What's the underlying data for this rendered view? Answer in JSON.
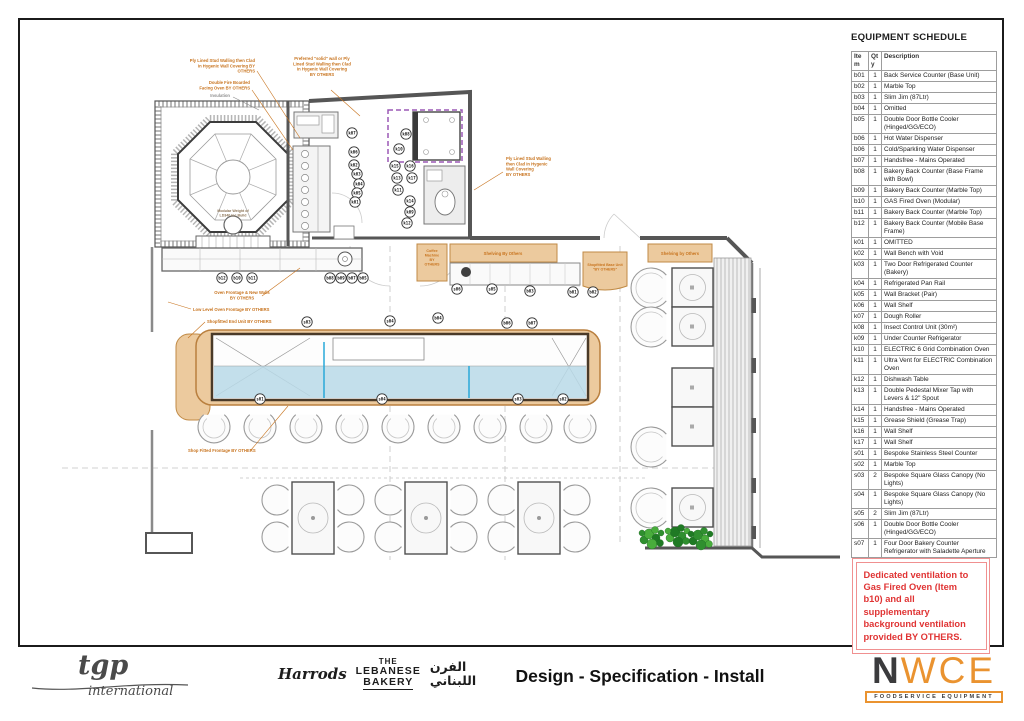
{
  "equipment_schedule": {
    "title": "EQUIPMENT SCHEDULE",
    "columns": [
      "Item",
      "Qty",
      "Description"
    ],
    "rows": [
      [
        "b01",
        "1",
        "Back Service Counter (Base Unit)"
      ],
      [
        "b02",
        "1",
        "Marble Top"
      ],
      [
        "b03",
        "1",
        "Slim Jim (87Ltr)"
      ],
      [
        "b04",
        "1",
        "Omitted"
      ],
      [
        "b05",
        "1",
        "Double Door Bottle Cooler (Hinged/GG/ECO)"
      ],
      [
        "b06",
        "1",
        "Hot Water Dispenser"
      ],
      [
        "b06",
        "1",
        "Cold/Sparkling Water Dispenser"
      ],
      [
        "b07",
        "1",
        "Handsfree - Mains Operated"
      ],
      [
        "b08",
        "1",
        "Bakery Back Counter (Base Frame with Bowl)"
      ],
      [
        "b09",
        "1",
        "Bakery Back Counter (Marble Top)"
      ],
      [
        "b10",
        "1",
        "GAS Fired Oven (Modular)"
      ],
      [
        "b11",
        "1",
        "Bakery Back Counter (Marble Top)"
      ],
      [
        "b12",
        "1",
        "Bakery Back Counter (Mobile Base Frame)"
      ],
      [
        "k01",
        "1",
        "OMITTED"
      ],
      [
        "k02",
        "1",
        "Wall Bench with Void"
      ],
      [
        "k03",
        "1",
        "Two Door Refrigerated Counter (Bakery)"
      ],
      [
        "k04",
        "1",
        "Refrigerated Pan Rail"
      ],
      [
        "k05",
        "1",
        "Wall Bracket (Pair)"
      ],
      [
        "k06",
        "1",
        "Wall Shelf"
      ],
      [
        "k07",
        "1",
        "Dough Roller"
      ],
      [
        "k08",
        "1",
        "Insect Control Unit (30m²)"
      ],
      [
        "k09",
        "1",
        "Under Counter Refrigerator"
      ],
      [
        "k10",
        "1",
        "ELECTRIC 6 Grid Combination Oven"
      ],
      [
        "k11",
        "1",
        "Ultra Vent for ELECTRIC Combination Oven"
      ],
      [
        "k12",
        "1",
        "Dishwash Table"
      ],
      [
        "k13",
        "1",
        "Double Pedestal Mixer Tap with Levers & 12\" Spout"
      ],
      [
        "k14",
        "1",
        "Handsfree - Mains Operated"
      ],
      [
        "k15",
        "1",
        "Grease Shield (Grease Trap)"
      ],
      [
        "k16",
        "1",
        "Wall Shelf"
      ],
      [
        "k17",
        "1",
        "Wall Shelf"
      ],
      [
        "s01",
        "1",
        "Bespoke Stainless Steel Counter"
      ],
      [
        "s02",
        "1",
        "Marble Top"
      ],
      [
        "s03",
        "2",
        "Bespoke Square Glass Canopy (No Lights)"
      ],
      [
        "s04",
        "1",
        "Bespoke Square Glass Canopy (No Lights)"
      ],
      [
        "s05",
        "2",
        "Slim Jim (87Ltr)"
      ],
      [
        "s06",
        "1",
        "Double Door Bottle Cooler (Hinged/GG/ECO)"
      ],
      [
        "s07",
        "1",
        "Four Door Bakery Counter Refrigerator with Saladette Aperture"
      ]
    ]
  },
  "ventilation_note": {
    "text": "Dedicated ventilation to Gas Fired Oven (Item b10) and all supplementary background ventilation provided BY OTHERS."
  },
  "plan": {
    "colors": {
      "annotation_orange": "#c8741f",
      "tan_fill": "#ecca9e",
      "counter_blue": "#b9d9e8",
      "canopy_purple": "#9b59b6",
      "note_red": "#e03434",
      "nwce_orange": "#ea9330"
    },
    "annotations": [
      {
        "lines": [
          "Ply Lined Stud Walling then Clad",
          "in Hygenic Wall Covering BY",
          "OTHERS"
        ],
        "x": 255,
        "y": 62,
        "anchor": "end",
        "leader": [
          257,
          71,
          300,
          138
        ]
      },
      {
        "lines": [
          "Double Fire Boarded",
          "Facing Oven BY OTHERS"
        ],
        "x": 250,
        "y": 84,
        "anchor": "end",
        "leader": [
          252,
          90,
          293,
          150
        ]
      },
      {
        "lines": [
          "Insulation"
        ],
        "x": 230,
        "y": 97,
        "anchor": "end",
        "color": "#909090",
        "leader": [
          233,
          97,
          259,
          110
        ],
        "leader_color": "#909090"
      },
      {
        "lines": [
          "Preferred \"solid\" wall or Ply",
          "Lined Stud Walling then Clad",
          "in Hygenic Wall Covering",
          "BY OTHERS"
        ],
        "x": 322,
        "y": 60,
        "anchor": "middle",
        "leader": [
          331,
          90,
          360,
          116
        ]
      },
      {
        "lines": [
          "Ply Lined Stud Walling",
          "then Clad in Hygenic",
          "Wall Covering",
          "BY OTHERS"
        ],
        "x": 506,
        "y": 160,
        "anchor": "start",
        "leader": [
          503,
          172,
          474,
          190
        ]
      },
      {
        "lines": [
          "Oven Frontage & New Walls",
          "BY OTHERS"
        ],
        "x": 242,
        "y": 294,
        "anchor": "middle",
        "leader": [
          262,
          296,
          300,
          268
        ]
      },
      {
        "lines": [
          "Low Level Oven Frontage BY OTHERS"
        ],
        "x": 193,
        "y": 311,
        "anchor": "start",
        "leader": [
          191,
          309,
          168,
          302
        ]
      },
      {
        "lines": [
          "Shopfitted End Unit BY OTHERS"
        ],
        "x": 207,
        "y": 323,
        "anchor": "start",
        "leader": [
          205,
          322,
          188,
          338
        ]
      },
      {
        "lines": [
          "Shop Fitted Frontage BY OTHERS"
        ],
        "x": 188,
        "y": 452,
        "anchor": "start",
        "leader": [
          251,
          450,
          288,
          406
        ]
      },
      {
        "lines": [
          "Shelving By Others"
        ],
        "x": 503,
        "y": 255,
        "anchor": "middle"
      },
      {
        "lines": [
          "Shelving by Others"
        ],
        "x": 680,
        "y": 255,
        "anchor": "middle"
      },
      {
        "lines": [
          "Coffee",
          "Machine",
          "BY",
          "OTHERS"
        ],
        "x": 432,
        "y": 252,
        "anchor": "middle",
        "size": 3.6
      },
      {
        "lines": [
          "Shopfitted Base Unit",
          "\"BY OTHERS\""
        ],
        "x": 605,
        "y": 266,
        "anchor": "middle",
        "size": 3.6
      },
      {
        "lines": [
          "Modular Weight of",
          "LD340 inc Build"
        ],
        "x": 233,
        "y": 212,
        "anchor": "middle",
        "size": 3.6,
        "color": "#8c7355"
      }
    ],
    "tags": [
      {
        "id": "b12",
        "x": 222,
        "y": 278
      },
      {
        "id": "b10",
        "x": 237,
        "y": 278
      },
      {
        "id": "b11",
        "x": 252,
        "y": 278
      },
      {
        "id": "b08",
        "x": 330,
        "y": 278
      },
      {
        "id": "b09",
        "x": 341,
        "y": 278
      },
      {
        "id": "b07",
        "x": 352,
        "y": 278
      },
      {
        "id": "b05",
        "x": 363,
        "y": 278
      },
      {
        "id": "k07",
        "x": 352,
        "y": 133
      },
      {
        "id": "k06",
        "x": 354,
        "y": 152
      },
      {
        "id": "k02",
        "x": 354,
        "y": 165
      },
      {
        "id": "k03",
        "x": 357,
        "y": 174
      },
      {
        "id": "k04",
        "x": 359,
        "y": 184
      },
      {
        "id": "k05",
        "x": 357,
        "y": 193
      },
      {
        "id": "k01",
        "x": 355,
        "y": 202
      },
      {
        "id": "k08",
        "x": 406,
        "y": 134
      },
      {
        "id": "k10",
        "x": 399,
        "y": 149
      },
      {
        "id": "k15",
        "x": 395,
        "y": 166
      },
      {
        "id": "k16",
        "x": 410,
        "y": 166
      },
      {
        "id": "k13",
        "x": 397,
        "y": 178
      },
      {
        "id": "k17",
        "x": 412,
        "y": 178
      },
      {
        "id": "k11",
        "x": 398,
        "y": 190
      },
      {
        "id": "k14",
        "x": 410,
        "y": 201
      },
      {
        "id": "k09",
        "x": 410,
        "y": 212
      },
      {
        "id": "k12",
        "x": 407,
        "y": 223
      },
      {
        "id": "s06",
        "x": 457,
        "y": 289
      },
      {
        "id": "s05",
        "x": 492,
        "y": 289
      },
      {
        "id": "b03",
        "x": 530,
        "y": 291
      },
      {
        "id": "b01",
        "x": 573,
        "y": 292
      },
      {
        "id": "b02",
        "x": 593,
        "y": 292
      },
      {
        "id": "s03",
        "x": 307,
        "y": 322
      },
      {
        "id": "s04",
        "x": 390,
        "y": 321
      },
      {
        "id": "b04",
        "x": 438,
        "y": 318
      },
      {
        "id": "b06",
        "x": 507,
        "y": 323
      },
      {
        "id": "b07",
        "x": 532,
        "y": 323
      },
      {
        "id": "s01",
        "x": 260,
        "y": 399
      },
      {
        "id": "s04",
        "x": 382,
        "y": 399
      },
      {
        "id": "s03",
        "x": 518,
        "y": 399
      },
      {
        "id": "s02",
        "x": 563,
        "y": 399
      }
    ]
  },
  "footer": {
    "tgp": {
      "wordmark": "tgp",
      "subtitle": "international"
    },
    "harrods": "Harrods",
    "bakery_lines": [
      "THE",
      "LEBANESE",
      "BAKERY"
    ],
    "arabic_lines": [
      "الفرن",
      "اللبناني"
    ],
    "sheet_title": "Design - Specification - Install",
    "nwce": {
      "n": "N",
      "wce": "WCE",
      "tagline": "FOODSERVICE EQUIPMENT"
    }
  }
}
